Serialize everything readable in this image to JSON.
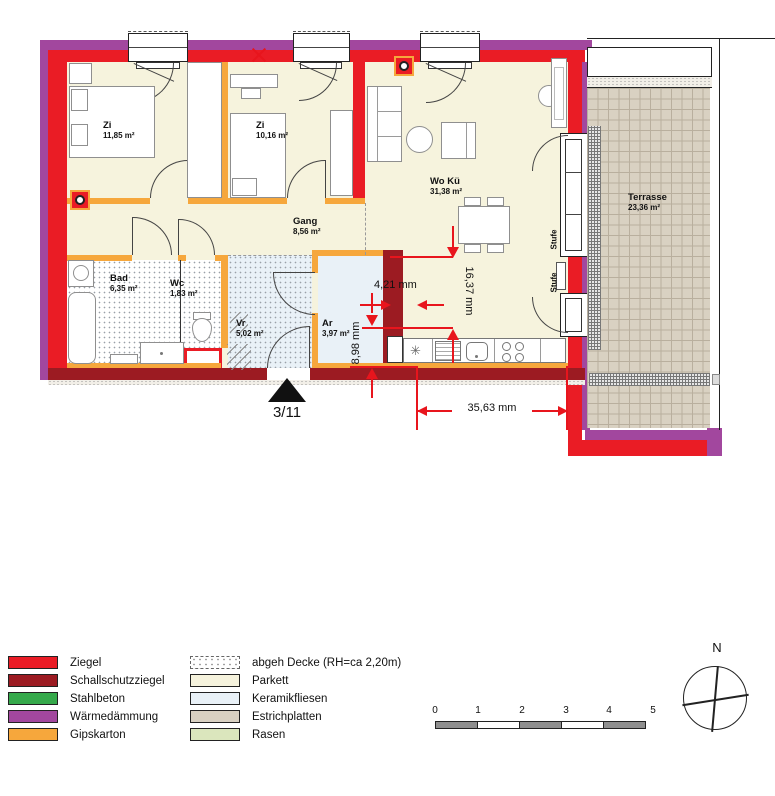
{
  "colors": {
    "ziegel": "#ea1c25",
    "schallschutz": "#9c1b22",
    "stahlbeton": "#35a94b",
    "waermedaemmung": "#a2479e",
    "gipskarton": "#f6a73c",
    "parkett": "#f6f3dd",
    "keramikfliesen": "#e9f1f7",
    "estrichplatten": "#d9d1c2",
    "rasen": "#dbe6bd",
    "dimension": "#e8151d"
  },
  "plan": {
    "rooms": [
      {
        "name": "Zi",
        "area": "11,85 m²"
      },
      {
        "name": "Zi",
        "area": "10,16 m²"
      },
      {
        "name": "Wo Kü",
        "area": "31,38 m²"
      },
      {
        "name": "Gang",
        "area": "8,56 m²"
      },
      {
        "name": "Bad",
        "area": "6,35 m²"
      },
      {
        "name": "Wc",
        "area": "1,83 m²"
      },
      {
        "name": "Vr",
        "area": "5,02 m²"
      },
      {
        "name": "Ar",
        "area": "3,97 m²"
      },
      {
        "name": "Terrasse",
        "area": "23,36 m²"
      }
    ],
    "dims": {
      "wall_width": "4,21 mm",
      "kitchen_height": "16,37 mm",
      "lower_height": "8,98 mm",
      "terrace_width": "35,63 mm"
    },
    "step_label": "Stufe",
    "entrance_label": "3/11"
  },
  "legend": {
    "left": [
      {
        "label": "Ziegel",
        "color": "#ea1c25"
      },
      {
        "label": "Schallschutzziegel",
        "color": "#9c1b22"
      },
      {
        "label": "Stahlbeton",
        "color": "#35a94b"
      },
      {
        "label": "Wärmedämmung",
        "color": "#a2479e"
      },
      {
        "label": "Gipskarton",
        "color": "#f6a73c"
      }
    ],
    "right": [
      {
        "label": "abgeh Decke (RH=ca 2,20m)",
        "color": "#ffffff"
      },
      {
        "label": "Parkett",
        "color": "#f6f3dd"
      },
      {
        "label": "Keramikfliesen",
        "color": "#e9f1f7"
      },
      {
        "label": "Estrichplatten",
        "color": "#d9d1c2"
      },
      {
        "label": "Rasen",
        "color": "#dbe6bd"
      }
    ]
  },
  "scalebar": {
    "ticks": [
      "0",
      "1",
      "2",
      "3",
      "4",
      "5"
    ]
  },
  "compass": {
    "north_label": "N"
  }
}
